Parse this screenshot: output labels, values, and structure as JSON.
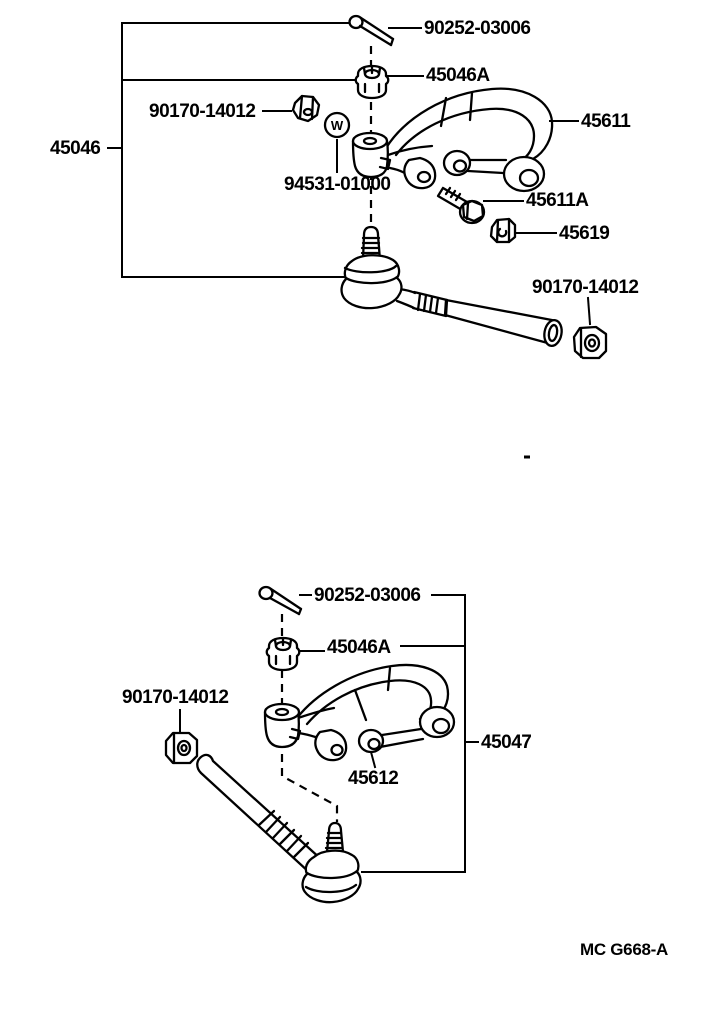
{
  "page": {
    "background": "#ffffff",
    "ink": "#000000"
  },
  "symbols": {
    "washer": "W"
  },
  "upper_assembly": {
    "group_label": "45046",
    "parts": {
      "cotter_pin": "90252-03006",
      "castle_nut": "45046A",
      "arm_nut": "90170-14012",
      "washer": "94531-01000",
      "knuckle_arm": "45611",
      "arm_bolt": "45611A",
      "plug": "45619",
      "rod_end_nut": "90170-14012"
    }
  },
  "lower_assembly": {
    "group_label": "45047",
    "parts": {
      "cotter_pin": "90252-03006",
      "castle_nut": "45046A",
      "arm_nut": "90170-14012",
      "knuckle_arm": "45612"
    }
  },
  "footer": {
    "diagram_code": "MC G668-A"
  }
}
